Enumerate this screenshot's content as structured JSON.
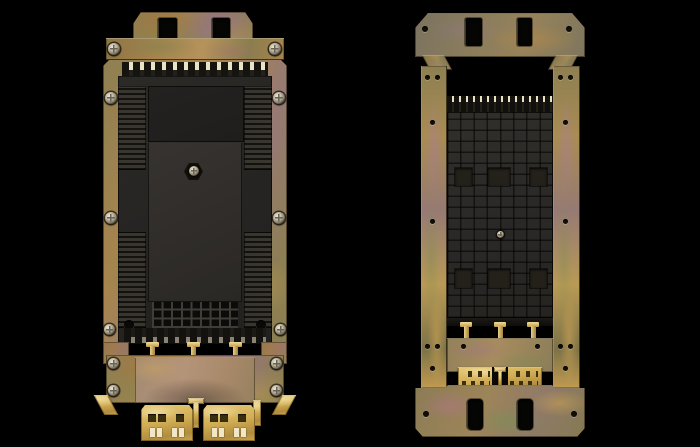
{
  "scene": {
    "type": "product-photograph",
    "alt": "Two yellow-zinc passivated steel mounting frames of a fiber splice closure shown on a black background: the left frame in front view carries a black plastic splice cassette with comb teeth and vent grid; the right frame in rear view shows two side rails around the recessed waffle-pattern back of the cassette; both have bright gold cable-routing combs at the bottom",
    "background": "#000000"
  },
  "left_assembly": {
    "alt": "Front view: frame plate with top mounting tab, cross bar with two screws, black splice cassette with comb teeth top and bottom, central screw, vent grid, lower bracket with four screws and two gold cable combs"
  },
  "right_assembly": {
    "alt": "Rear view: top mounting plate with two slots, two iridescent side rails, recessed black cassette back with waffle pattern and three gold T-studs, lower plate and gold comb, bottom plate with two slots"
  },
  "colors": {
    "background": "#000000",
    "metal_olive": "#8d7f52",
    "metal_bronze": "#a8854d",
    "metal_gold": "#c09a50",
    "metal_mauve": "#967a74",
    "metal_green": "#76774a",
    "metal_bright": "#d8c98f",
    "comb_gold": "#d2ae55",
    "comb_gold_light": "#e6cb7c",
    "comb_slot": "#3a2f0e",
    "plastic_dark": "#262422",
    "plastic_mid": "#2e2c29",
    "plastic_light": "#3a3733",
    "screw_silver": "#c9c4b2",
    "screw_ring": "#22201c"
  }
}
